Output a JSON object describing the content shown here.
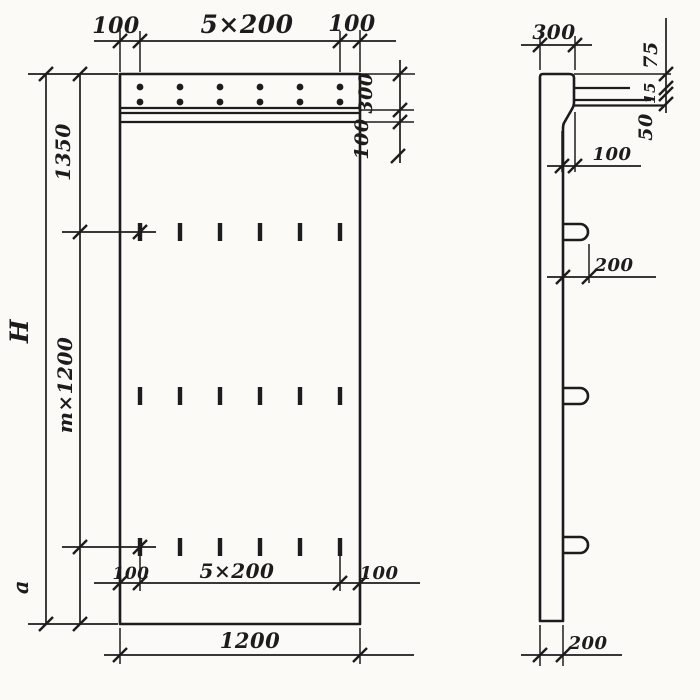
{
  "colors": {
    "ink": "#1c1c1c",
    "paper": "#fbfaf7"
  },
  "front_view": {
    "top_dims": {
      "left_edge": "100",
      "spacing": "5×200",
      "right_edge": "100"
    },
    "height_dims": {
      "top_zone": "1350",
      "modular": "m×1200",
      "bottom_zone": "a",
      "overall": "H"
    },
    "band_dims": {
      "band_height": "300",
      "strip_height": "100"
    },
    "bottom_dims": {
      "left_edge": "100",
      "spacing": "5×200",
      "right_edge": "100",
      "width": "1200"
    }
  },
  "side_view": {
    "top_width": "300",
    "edge_dims": {
      "top": "75",
      "bar": "15",
      "gap": "50"
    },
    "ledge_offset": "100",
    "loop_length": "200",
    "thickness": "200"
  }
}
